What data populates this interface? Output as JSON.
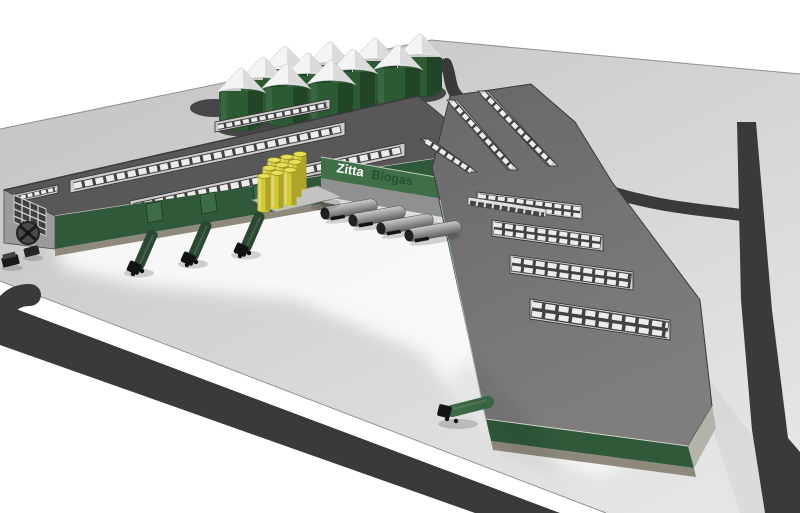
{
  "sign": {
    "primary": "Zitta",
    "secondary": "Biogas"
  },
  "colors": {
    "page_bg": "#ffffff",
    "ground_far": "#c2c2c2",
    "ground_near": "#e5e5e5",
    "apron_white": "#fbfbfb",
    "road_dark": "#3a3a3a",
    "roof_left_wing": "#585858",
    "roof_right_wing": "#686868",
    "roof_right_wing_light": "#7e7e7e",
    "skylight_frame": "#cccccc",
    "skylight_pane_light": "#ececec",
    "skylight_pane_dark": "#424242",
    "wall_green": "#30593a",
    "wall_green_dark": "#274a30",
    "sign_band_green": "#3e6f47",
    "sign_text_primary": "#ffffff",
    "sign_text_secondary": "#294f31",
    "silo_green": "#2b5a33",
    "silo_cone_white": "#f4f4f4",
    "silo_pad_dark": "#464646",
    "foundation_tan": "#8e897a",
    "gable_gray": "#9b9b9b",
    "truck_green": "#2b4832",
    "truck_green_light": "#3c6b46",
    "trailer_gray_light": "#cccccc",
    "trailer_gray_dark": "#5d5d5d",
    "tank_yellow": "#d2c938",
    "tank_yellow_top": "#e7e058",
    "platform_gray": "#c3c3c3",
    "tip_side_gray": "#b4b3a9"
  },
  "objects": {
    "silos": 11,
    "empty_silo_pads": 1,
    "yellow_tanks": 9,
    "tanker_trailers": 4,
    "dock_trucks_left_wing": 3,
    "dock_trucks_right_wing": 1,
    "parked_vehicles": 2,
    "skylight_strips_left_wing": 4,
    "skylight_strips_junction_diagonal": 3,
    "skylight_strips_right_wing": 4,
    "wall_window_strips": 1,
    "access_roads": 3
  }
}
